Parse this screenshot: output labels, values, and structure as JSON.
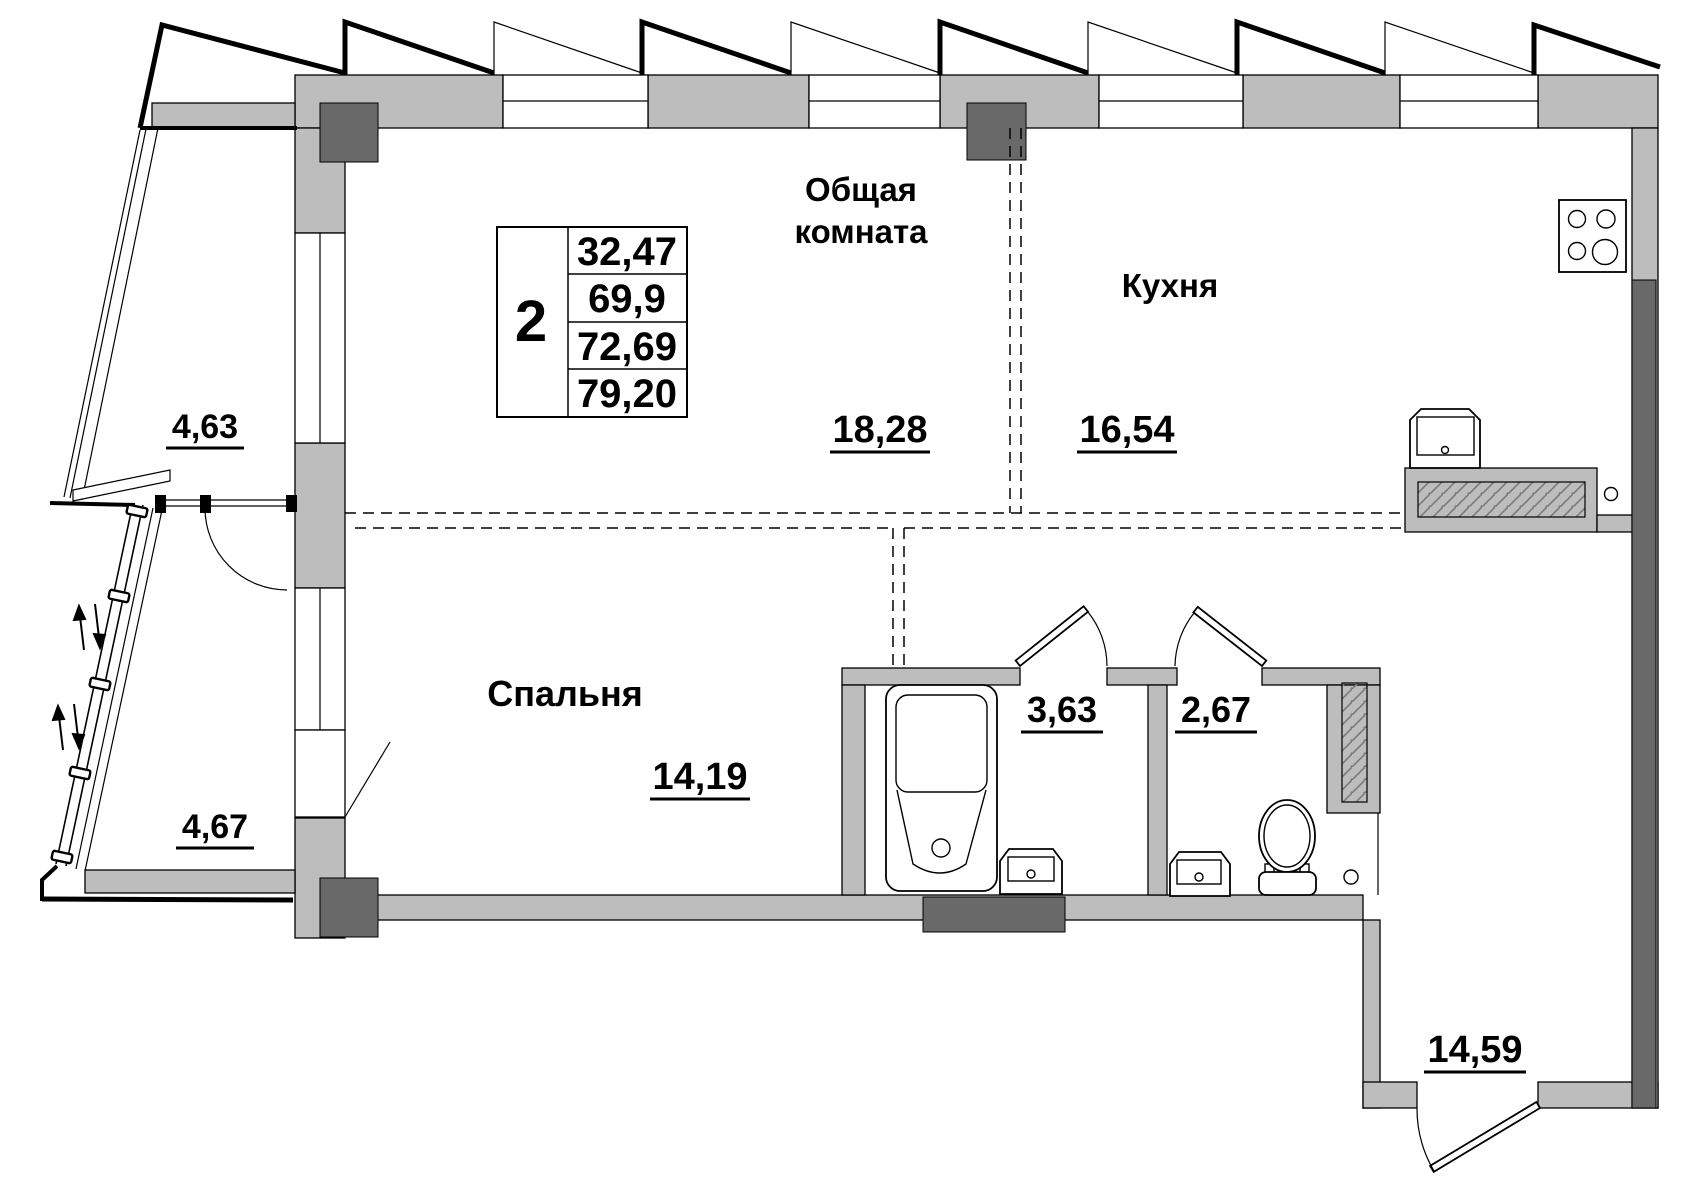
{
  "page_title": "Floor plan — 2-room apartment",
  "title_block": {
    "rooms_count": "2",
    "areas": [
      "32,47",
      "69,9",
      "72,69",
      "79,20"
    ]
  },
  "rooms": {
    "living": {
      "name_line1": "Общая",
      "name_line2": "комната",
      "area": "18,28"
    },
    "kitchen": {
      "name": "Кухня",
      "area": "16,54"
    },
    "bedroom": {
      "name": "Спальня",
      "area": "14,19"
    },
    "bathroom": {
      "area": "3,63"
    },
    "toilet": {
      "area": "2,67"
    },
    "hallway": {
      "area": "14,59"
    },
    "balcony_upper": {
      "area": "4,63"
    },
    "balcony_lower": {
      "area": "4,67"
    }
  },
  "colors": {
    "wall_fill": "#bdbdbd",
    "dark_fill": "#696969",
    "hatch_line": "#7a7a7a",
    "line": "#000000",
    "background": "#ffffff"
  }
}
